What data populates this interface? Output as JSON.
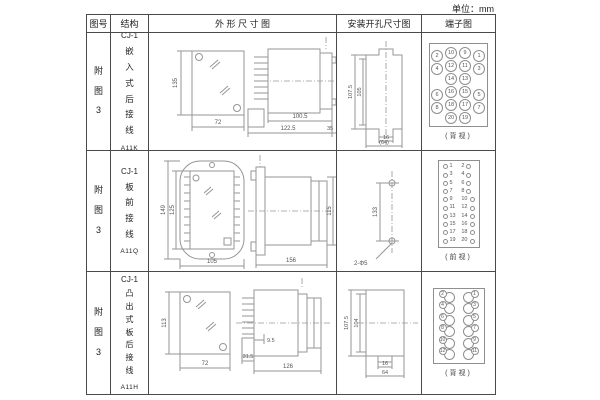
{
  "unit_label": "单位：mm",
  "table": {
    "headers": [
      "图号",
      "结构",
      "外 形 尺 寸 图",
      "安装开孔尺寸图",
      "端子图"
    ]
  },
  "rows": [
    {
      "figure_no": "附图3",
      "structure": {
        "prefix": "CJ-1",
        "name": "嵌入式后接线",
        "model": "A11K"
      },
      "outline": {
        "front_height": "135",
        "front_width": "72",
        "body_length": "100.5",
        "total_length": "122.5",
        "rear_length": "35"
      },
      "install": {
        "outer_height": "107.5",
        "inner_height": "105",
        "tab_width": "16",
        "total_width": "(64)"
      },
      "terminal": {
        "caption": "(背视)",
        "pins": [
          {
            "outer_left": "2",
            "mid_left": "10",
            "mid_right": "9",
            "outer_right": "1"
          },
          {
            "outer_left": "4",
            "mid_left": "12",
            "mid_right": "11",
            "outer_right": "3"
          },
          {
            "mid_left": "14",
            "mid_right": "13"
          },
          {
            "outer_left": "6",
            "mid_left": "16",
            "mid_right": "15",
            "outer_right": "5"
          },
          {
            "outer_left": "8",
            "mid_left": "18",
            "mid_right": "17",
            "outer_right": "7"
          },
          {
            "mid_left": "20",
            "mid_right": "19"
          }
        ]
      }
    },
    {
      "figure_no": "附图3",
      "structure": {
        "prefix": "CJ-1",
        "name": "板前接线",
        "model": "A11Q"
      },
      "outline": {
        "outer_height": "149",
        "inner_height": "125",
        "front_width": "105",
        "side_length": "156",
        "side_height": "115"
      },
      "install": {
        "hole_spacing": "133",
        "hole_label": "2-Φ5"
      },
      "terminal": {
        "caption": "(前视)",
        "left": [
          "1",
          "3",
          "5",
          "7",
          "9",
          "11",
          "13",
          "15",
          "17",
          "19"
        ],
        "right": [
          "2",
          "4",
          "6",
          "8",
          "10",
          "12",
          "14",
          "16",
          "18",
          "20"
        ]
      }
    },
    {
      "figure_no": "附图3",
      "structure": {
        "prefix": "CJ-1",
        "name": "凸出式板后接线",
        "model": "A11H"
      },
      "outline": {
        "front_height": "113",
        "front_width": "72",
        "base_width": "31.5",
        "pin_length": "9.5",
        "total_length": "126"
      },
      "install": {
        "outer_height": "107.5",
        "inner_height": "104",
        "tab_width": "16",
        "total_width": "64"
      },
      "terminal": {
        "caption": "(背视)",
        "left": [
          "2",
          "4",
          "6",
          "8",
          "10",
          "12"
        ],
        "right": [
          "1",
          "3",
          "5",
          "7",
          "9",
          "11"
        ]
      }
    }
  ]
}
